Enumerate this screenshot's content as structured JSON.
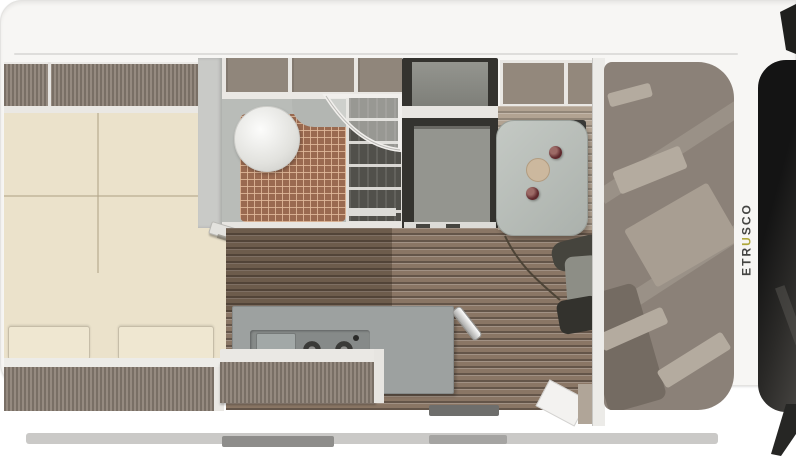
{
  "brand": {
    "full": "ETRUSCO",
    "prefix": "ETR",
    "accent": "U",
    "suffix": "SCO",
    "accent_color": "#b0a83c",
    "text_color": "#454543"
  },
  "palette": {
    "background": "#ffffff",
    "body_shell": "#f7f6f4",
    "mattress_cream": "#ebe2cb",
    "locker_taupe": "#8d8176",
    "bathroom_gray": "#b9bcb8",
    "shower_tile_terracotta": "#9a6a50",
    "wood_floor": "#8a7665",
    "wood_floor_light": "#b2a392",
    "kitchen_counter_gray": "#9da1a0",
    "table_gray": "#bcc2bd",
    "cup_red": "#5e282c",
    "plate_beige": "#ccb89e",
    "cab_roof_taupe": "#8b8178",
    "windshield_black": "#1f1f1d",
    "dark_unit": "#34332f"
  }
}
